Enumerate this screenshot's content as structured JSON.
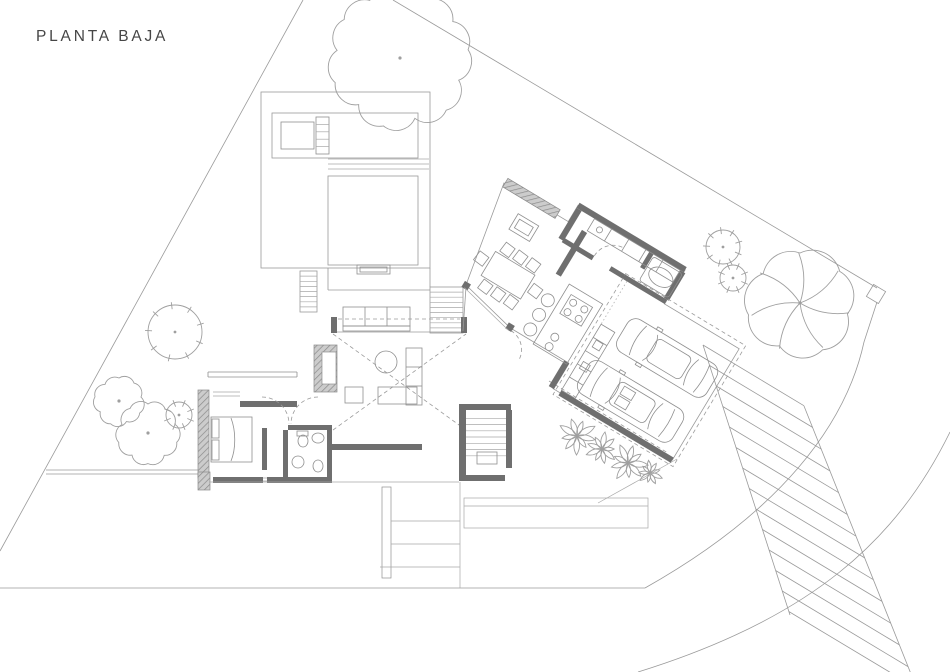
{
  "title": "PLANTA BAJA",
  "colors": {
    "bg": "#ffffff",
    "line": "#9a9a9a",
    "walls": "#6f6f6f",
    "hatch": "#c9c9c9",
    "text": "#464646"
  }
}
